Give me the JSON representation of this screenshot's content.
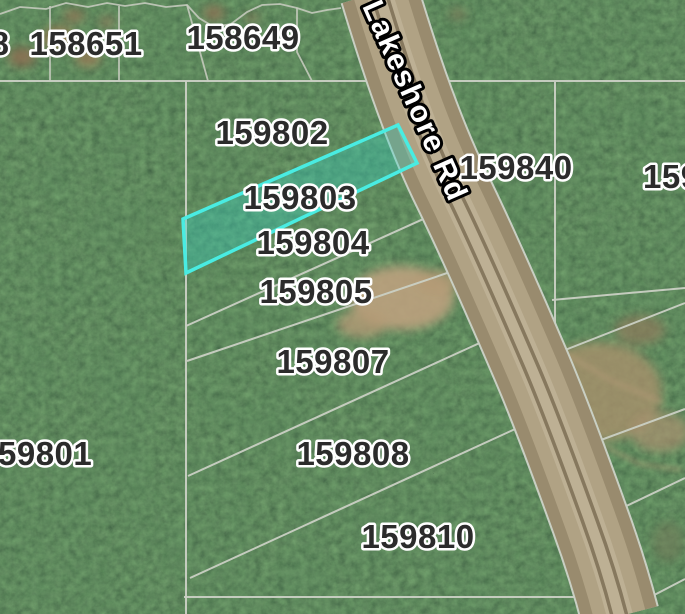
{
  "app": {
    "view": "parcel-map-satellite",
    "description": "GIS parcel viewer over aerial forest imagery"
  },
  "road": {
    "label": "Lakeshore Rd"
  },
  "selection": {
    "selected_parcel_id": "159803",
    "highlight_stroke": "#49ece2",
    "highlight_fill": "rgba(47,216,204,0.33)"
  },
  "parcel_labels": {
    "top_left_partial": "8",
    "p158651": "158651",
    "p158649": "158649",
    "p159802": "159802",
    "p159803": "159803",
    "p159804": "159804",
    "p159805": "159805",
    "p159807": "159807",
    "p159808": "159808",
    "p159810": "159810",
    "p159801_partial": "59801",
    "p159840": "159840",
    "right_edge_partial": "159"
  },
  "colors": {
    "boundary_line": "#cad0c4",
    "label_text": "#2b2b2b",
    "label_halo": "#ffffff",
    "road_surface": "#a89a7c",
    "road_label_fill": "#ffffff",
    "road_label_outline": "#000000",
    "forest_base": "#24391f"
  }
}
